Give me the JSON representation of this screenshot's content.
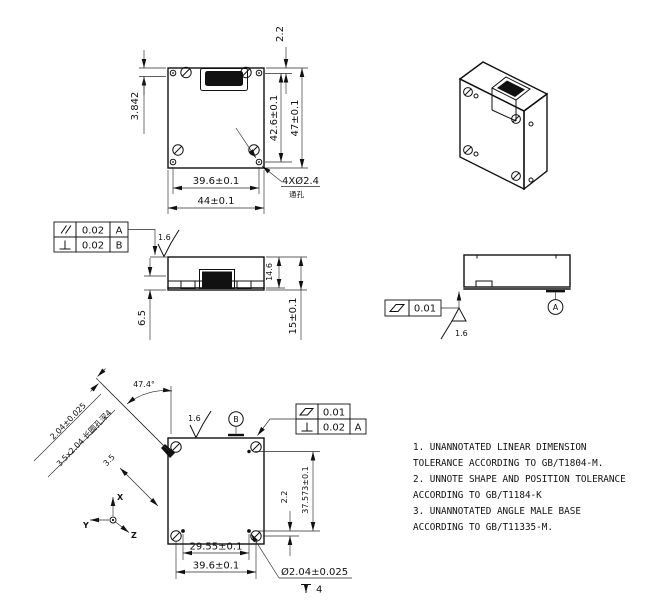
{
  "colors": {
    "line": "#111111",
    "background": "#ffffff"
  },
  "front_view": {
    "dim_offset_top": "3.842",
    "dim_connector_offset": "2.2",
    "dim_hole_spacing_v": "42.6±0.1",
    "dim_height": "47±0.1",
    "dim_hole_spacing_h": "39.6±0.1",
    "dim_width": "44±0.1",
    "hole_callout": "4XØ2.4",
    "hole_callout_note": "通孔"
  },
  "side_view": {
    "fcf_rows": [
      {
        "symbol": "parallelism",
        "tolerance": "0.02",
        "datum": "A"
      },
      {
        "symbol": "perpendicularity",
        "tolerance": "0.02",
        "datum": "B"
      }
    ],
    "roughness": "1.6",
    "dim_inner_height": "14.6",
    "dim_height": "15±0.1",
    "dim_bottom": "6.5"
  },
  "right_side_view": {
    "fcf": {
      "symbol": "flatness",
      "tolerance": "0.01"
    },
    "roughness": "1.6",
    "datum_label": "A"
  },
  "bottom_view": {
    "dim_angle": "47.4°",
    "dim_slot_width": "2.04±0.025",
    "slot_callout": "3.5x2.04 长圆孔深4",
    "dim_slot_offset": "3.5",
    "roughness": "1.6",
    "datum_label": "B",
    "fcf_rows": [
      {
        "symbol": "flatness",
        "tolerance": "0.01"
      },
      {
        "symbol": "perpendicularity",
        "tolerance": "0.02",
        "datum": "A"
      }
    ],
    "dim_hole_offset": "2.2",
    "dim_hole_spacing_v": "37.573±0.1",
    "dim_small_hole_spacing": "29.55±0.1",
    "dim_hole_spacing_h": "39.6±0.1",
    "hole_callout": "Ø2.04±0.025",
    "hole_depth": "4",
    "axes": {
      "x": "X",
      "y": "Y",
      "z": "Z"
    }
  },
  "notes": {
    "lines": [
      "1. UNANNOTATED LINEAR DIMENSION",
      "TOLERANCE ACCORDING TO GB/T1804-M.",
      "2. UNNOTE SHAPE AND POSITION TOLERANCE",
      "ACCORDING TO GB/T1184-K",
      "3. UNANNOTATED ANGLE MALE BASE",
      "ACCORDING TO GB/T11335-M."
    ]
  }
}
